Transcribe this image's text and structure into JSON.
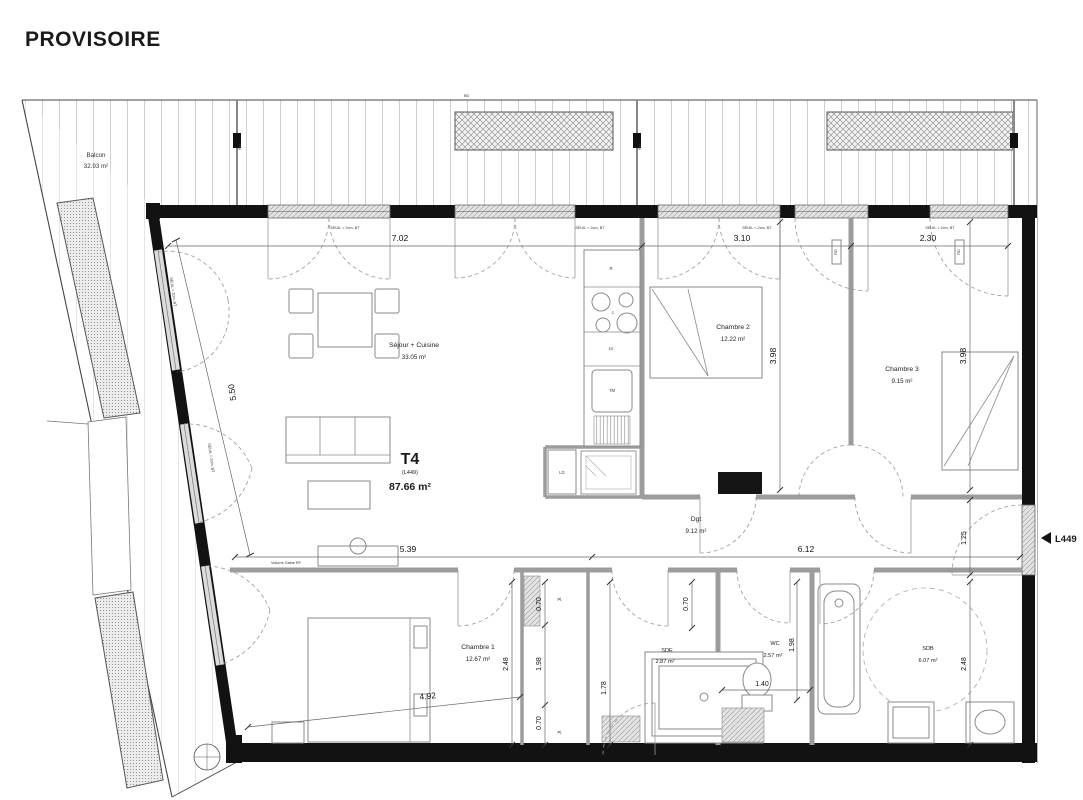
{
  "title": "PROVISOIRE",
  "plan": {
    "balcony": {
      "name": "Balcon",
      "area": "32.93 m²"
    },
    "unit": {
      "type": "T4",
      "lot": "(L449)",
      "area": "87.66 m²"
    },
    "entry_marker": "L449",
    "rooms": {
      "sejour": {
        "name": "Séjour + Cuisine",
        "area": "33.05 m²"
      },
      "chambre2": {
        "name": "Chambre 2",
        "area": "12.22 m²"
      },
      "chambre3": {
        "name": "Chambre 3",
        "area": "9.15 m²"
      },
      "dgt": {
        "name": "Dgt",
        "area": "9.12 m²"
      },
      "chambre1": {
        "name": "Chambre 1",
        "area": "12.67 m²"
      },
      "sde": {
        "name": "SDE",
        "area": "2.87 m²"
      },
      "wc": {
        "name": "WC",
        "area": "2.57 m²"
      },
      "sdb": {
        "name": "SDB",
        "area": "6.07 m²"
      }
    },
    "dims": {
      "sejour_top": "7.02",
      "ch2_top": "3.10",
      "ch3_top": "2.30",
      "ch2_side": "3.98",
      "ch3_side": "3.98",
      "sejour_diag": "5.50",
      "sejour_bottom": "5.39",
      "dgt_width": "6.12",
      "entry_side": "1.25",
      "ch1_side": "2.48",
      "ch1_bottom": "4.92",
      "closet_top": "0.70",
      "closet_mid": "1.98",
      "closet_bottom": "0.70",
      "sde_top": "0.70",
      "sde_side": "1.78",
      "wc_side": "1.98",
      "wc_width": "1.40",
      "sdb_side": "2.48"
    },
    "annotations": {
      "seuil": "SEUIL < 2cm, BT",
      "duct_note": "Volume Gaine RF",
      "bd": "BD",
      "pm": "PM",
      "rd": "RD",
      "pl": "Pl."
    },
    "kitchen": {
      "fridge": "R",
      "hob": "C",
      "dishwasher": "LV",
      "sink": "TM",
      "washer": "LG"
    }
  }
}
